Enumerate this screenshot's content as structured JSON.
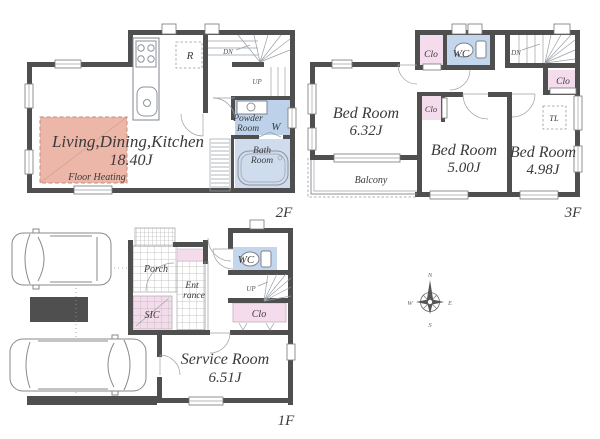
{
  "title": "House floor plan",
  "colors": {
    "wall": "#4f4f4f",
    "closet_pink": "#f5dcec",
    "floor_heating_pink": "#ecb7a8",
    "wc_blue": "#c3d6ec",
    "powder_blue": "#bdd2ea",
    "bath_blue": "#cfdcee"
  },
  "floor2": {
    "label": "2F",
    "ldk_name": "Living,Dining,Kitchen",
    "ldk_area": "18.40J",
    "floor_heating": "Floor Heating",
    "fridge": "R",
    "stairs_dn": "DN",
    "stairs_up": "UP",
    "powder_line1": "Powder",
    "powder_line2": "Room",
    "washer": "W",
    "bath_line1": "Bath",
    "bath_line2": "Room"
  },
  "floor3": {
    "label": "3F",
    "bedrooms": [
      {
        "name": "Bed Room",
        "area": "6.32J"
      },
      {
        "name": "Bed Room",
        "area": "5.00J"
      },
      {
        "name": "Bed Room",
        "area": "4.98J"
      }
    ],
    "closet_top": "Clo",
    "closet_mid": "Clo",
    "closet_right": "Clo",
    "wc": "WC",
    "tl": "TL",
    "stairs_dn": "DN",
    "balcony": "Balcony"
  },
  "floor1": {
    "label": "1F",
    "porch": "Porch",
    "entrance_line1": "Ent",
    "entrance_line2": "rance",
    "sic": "SIC",
    "wc": "WC",
    "stairs_up": "UP",
    "closet": "Clo",
    "service_room_name": "Service Room",
    "service_room_area": "6.51J"
  },
  "compass": {
    "n": "N",
    "e": "E",
    "s": "S",
    "w": "W"
  }
}
